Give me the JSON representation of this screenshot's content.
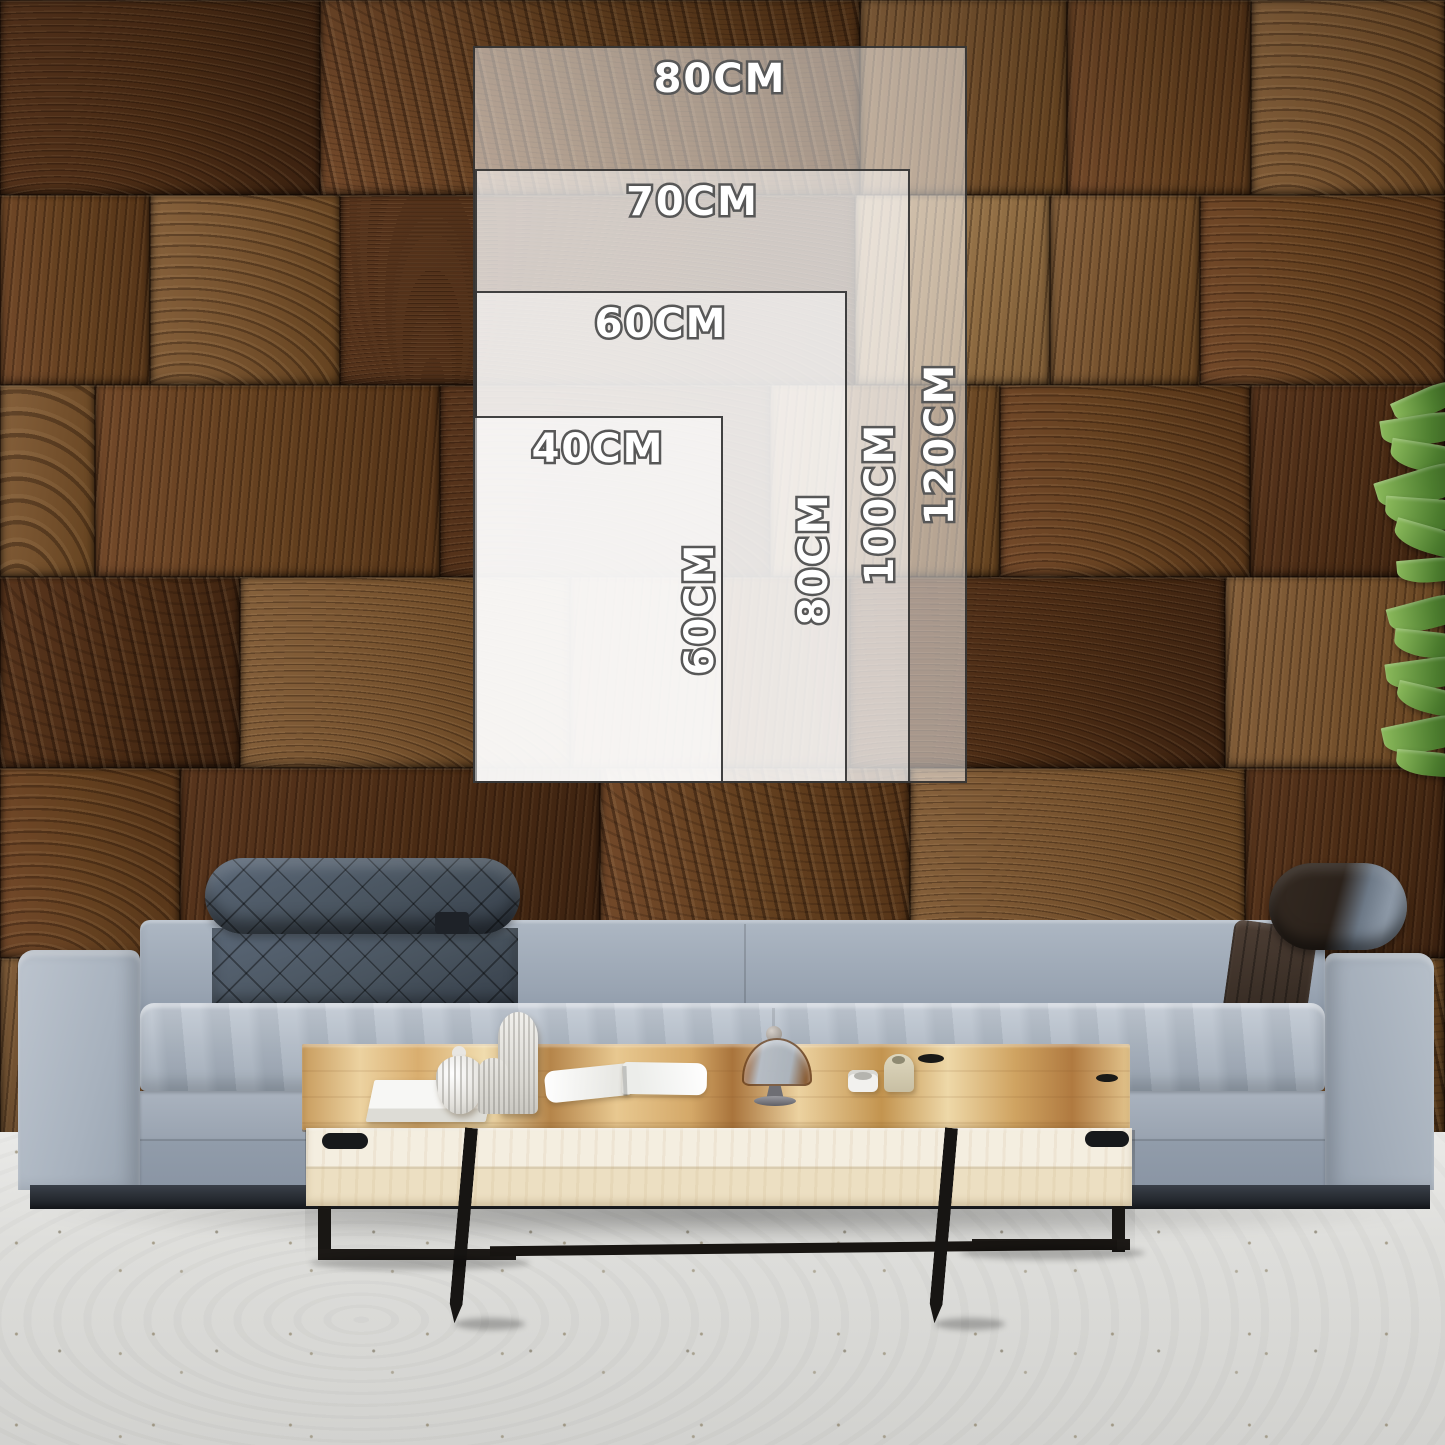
{
  "size_guide": {
    "unit": "CM",
    "sizes": [
      {
        "name": "80x120",
        "width_label": "80CM",
        "height_label": "120CM"
      },
      {
        "name": "70x100",
        "width_label": "70CM",
        "height_label": "100CM"
      },
      {
        "name": "60x80",
        "width_label": "60CM",
        "height_label": "80CM"
      },
      {
        "name": "40x60",
        "width_label": "40CM",
        "height_label": "60CM"
      }
    ]
  },
  "palette": {
    "overlay_fill": "rgba(255,255,255,0.5)",
    "overlay_border": "#282828",
    "label_text": "#ffffff",
    "label_outline": "#585858",
    "wood_dark": "#4a2b14",
    "wood_mid": "#74502c",
    "wood_light": "#a5845c",
    "sofa_fabric": "#a9b3bf",
    "sofa_headrest": "#49545f",
    "bolster_leather": "#2e2620",
    "floor": "#dededb",
    "table_wood": "#e5c38c",
    "table_apron": "#f0e9d8",
    "leg_metal": "#191714",
    "plant_green": "#4c7c2e"
  }
}
